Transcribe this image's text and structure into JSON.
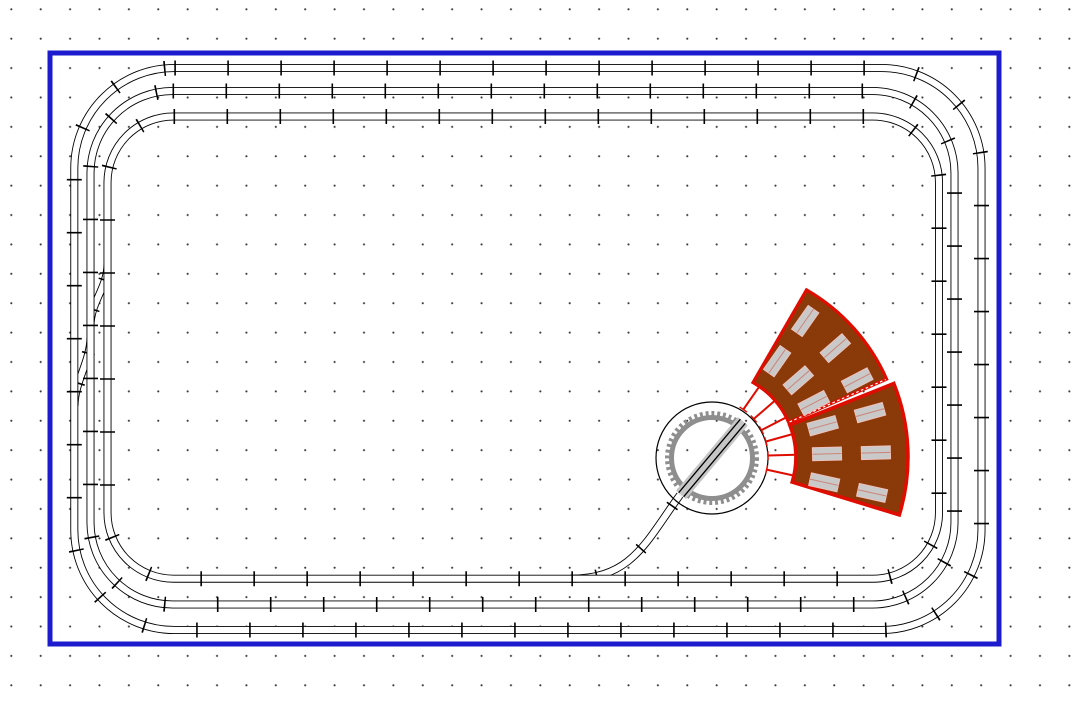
{
  "app": {
    "name": "track-plan-editor",
    "description": "Model railway track plan: three concentric track loops on a baseboard, two crossovers on the left, a turntable with lead track and a two-segment roundhouse on the right"
  },
  "canvas": {
    "width": 1090,
    "height": 706,
    "background": "#FFFFFF",
    "grid": {
      "spacing": 29.4,
      "offset_x": 26,
      "offset_y": 24,
      "dot_color": "#3C3C3C",
      "dot_radius": 0.9
    }
  },
  "baseboard": {
    "x": 50,
    "y": 53,
    "width": 949,
    "height": 591,
    "stroke_color": "#1C1CCE",
    "stroke_width": 5
  },
  "track_style": {
    "rail_color": "#000000",
    "bed_width": 8,
    "clear_color": "#FFFFFF",
    "clear_width": 6.2,
    "tick_color": "#000000",
    "tick_length": 15,
    "tick_thickness": 1.6,
    "tick_period": 53
  },
  "loops": [
    {
      "id": "outer-loop",
      "x": 74.3,
      "y": 68,
      "width": 907.2,
      "height": 562,
      "corner_radius": 100
    },
    {
      "id": "middle-loop",
      "x": 90.5,
      "y": 91,
      "width": 864,
      "height": 513.5,
      "corner_radius": 82
    },
    {
      "id": "inner-loop",
      "x": 107.5,
      "y": 116.5,
      "width": 831.5,
      "height": 462.2,
      "corner_radius": 66
    }
  ],
  "connectors": [
    {
      "id": "crossover-upper",
      "path": "M 107.5 264 C 107.5 288 90.5 302 90.5 326",
      "tick_dash": "1.6 30",
      "tick_offset": 16,
      "tick_length": 13
    },
    {
      "id": "crossover-lower",
      "path": "M 90.5 337 C 90.5 361 74.5 382 74.5 406",
      "tick_dash": "1.6 30",
      "tick_offset": 16,
      "tick_length": 13
    },
    {
      "id": "turntable-lead-track",
      "path": "M 570 578.7 C 632 578.7 645 543 680 495",
      "tick_dash": "1.6 51.4",
      "tick_offset": 27,
      "tick_length": 13
    }
  ],
  "turntable": {
    "cx": 712,
    "cy": 458,
    "pit_radius": 56,
    "pit_stroke": "#000000",
    "pit_stroke_width": 1.2,
    "ring_radius": 40.5,
    "ring_width": 5,
    "ring_color": "#8E8E8E",
    "teeth_radius": 44.5,
    "teeth_width": 5,
    "teeth_dash": "2.9 2.9",
    "bridge_angle_deg": -50,
    "bridge_length": 96,
    "bridge_band_width": 13,
    "bridge_band_color": "#C6C6C6",
    "bridge_rail_offset": 3.2,
    "bridge_rail_color": "#000000",
    "bridge_rail_width": 1.3
  },
  "roundhouse": {
    "cx": 710,
    "cy": 457,
    "fill": "#8A3909",
    "outline": "#DE0D00",
    "segments": [
      {
        "id": "upper",
        "a0": -60,
        "a1": -23.8,
        "r_inner": 86,
        "r_outer": 193,
        "stroke_width": 3.2
      },
      {
        "id": "lower",
        "a0": -21.8,
        "a1": 17,
        "r_inner": 86,
        "r_outer": 198,
        "stroke_width": 3.6
      }
    ],
    "divider": {
      "angle": -23.8,
      "r0": 87,
      "r1": 192,
      "color": "#FFFFFF",
      "width": 1.2,
      "dash": "2.6 2.6"
    },
    "stalls": {
      "angles": [
        -55,
        -41,
        -27.5,
        -15.5,
        -1.5,
        12.5
      ],
      "lead_r0": 58,
      "lead_r1": 86,
      "lead_color": "#DE0D00",
      "lead_width": 2,
      "cap_half_length": 4.5,
      "cap_width": 1.4
    },
    "skylights": {
      "radii": [
        117,
        166
      ],
      "length": 29,
      "width": 13,
      "fill": "#C9C9C9",
      "stroke": "#EFC2BC",
      "stroke_width": 1,
      "mid_line_color": "#CC8478",
      "mid_line_width": 1
    }
  }
}
